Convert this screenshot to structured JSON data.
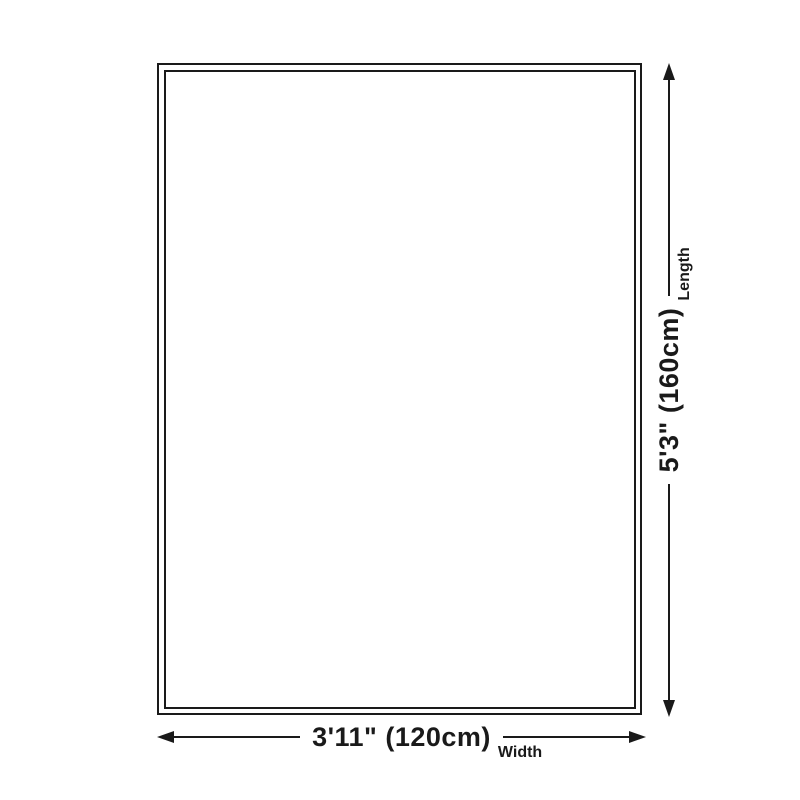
{
  "diagram": {
    "title": "rug-size-diagram",
    "background_color": "#ffffff",
    "line_color": "#1a1a1a",
    "width_dimension": {
      "value": "3'11\" (120cm)",
      "label": "Width"
    },
    "length_dimension": {
      "value": "5'3\" (160cm)",
      "label": "Length"
    }
  }
}
